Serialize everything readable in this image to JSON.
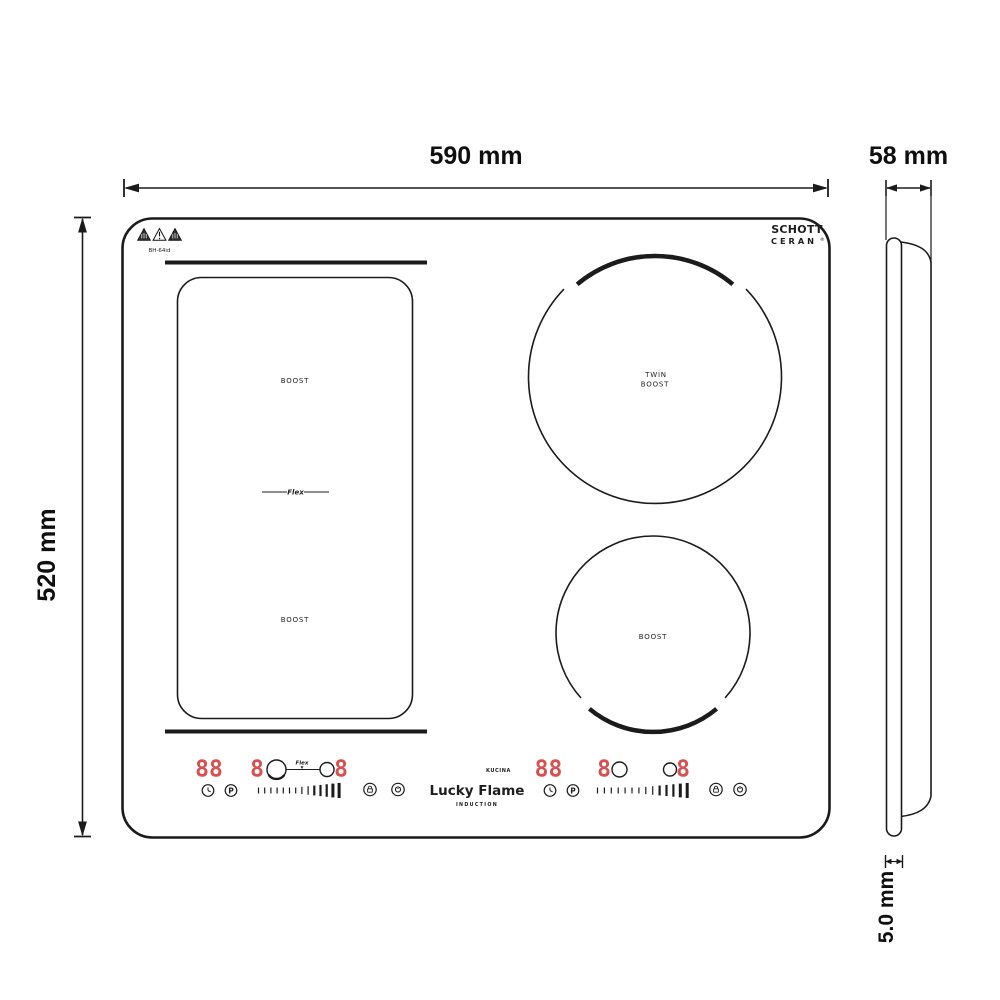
{
  "annotations": {
    "width": "590 mm",
    "depth": "58 mm",
    "height": "520 mm",
    "glass_thickness": "5.0 mm"
  },
  "hob": {
    "model": "BH-64id",
    "glass_brand": {
      "line1": "SCHOTT",
      "line2": "CERAN",
      "registered": "®"
    },
    "flex_zone": {
      "boost_top": "BOOST",
      "flex": "Flex",
      "boost_bottom": "BOOST"
    },
    "twin_zone": {
      "line1": "TWIN",
      "line2": "BOOST"
    },
    "single_zone": {
      "label": "BOOST"
    },
    "brand": {
      "series": "KUCINA",
      "name": "Lucky Flame",
      "tagline": "INDUCTION"
    },
    "left_panel": {
      "timer_display": "88",
      "zone_left_level": "8",
      "zone_right_level": "8",
      "flex_label": "Flex",
      "power_key": "P"
    },
    "right_panel": {
      "timer_display": "88",
      "zone_left_level": "8",
      "zone_right_level": "8",
      "power_key": "P"
    },
    "icons": {
      "warnings": [
        "hot-surface-warning-icon",
        "caution-warning-icon",
        "hot-surface-warning-icon"
      ],
      "panel_icons": [
        "timer-clock-icon",
        "power-level-icon",
        "keylock-icon",
        "power-icon"
      ]
    }
  },
  "colors": {
    "line": "#1b1b1b",
    "display_red": "#d95050"
  }
}
